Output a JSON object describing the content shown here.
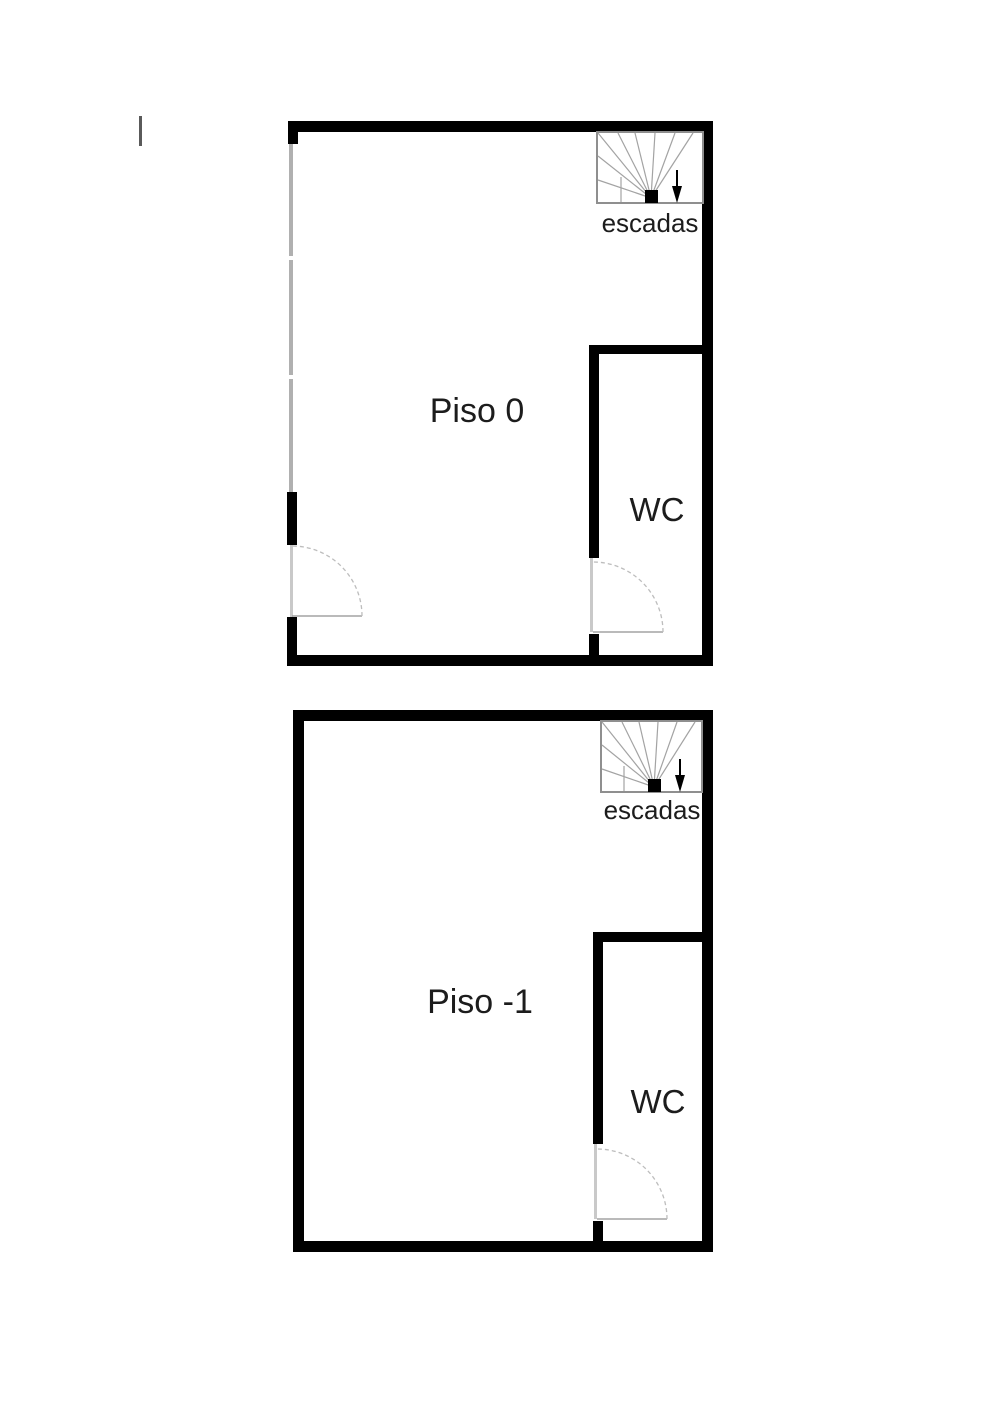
{
  "plans": [
    {
      "room_label": "Piso 0",
      "stairs_label": "escadas",
      "wc_label": "WC"
    },
    {
      "room_label": "Piso -1",
      "stairs_label": "escadas",
      "wc_label": "WC"
    }
  ],
  "colors": {
    "background": "#ffffff",
    "wall": "#000000",
    "glass": "#b0b0b0",
    "jamb": "#c9c9c9",
    "stairoutline": "#8f8f8f",
    "stairline": "#a3a3a3",
    "arc": "#bdbdbd",
    "text": "#1c1c1c",
    "stray": "#5a5a5a"
  }
}
